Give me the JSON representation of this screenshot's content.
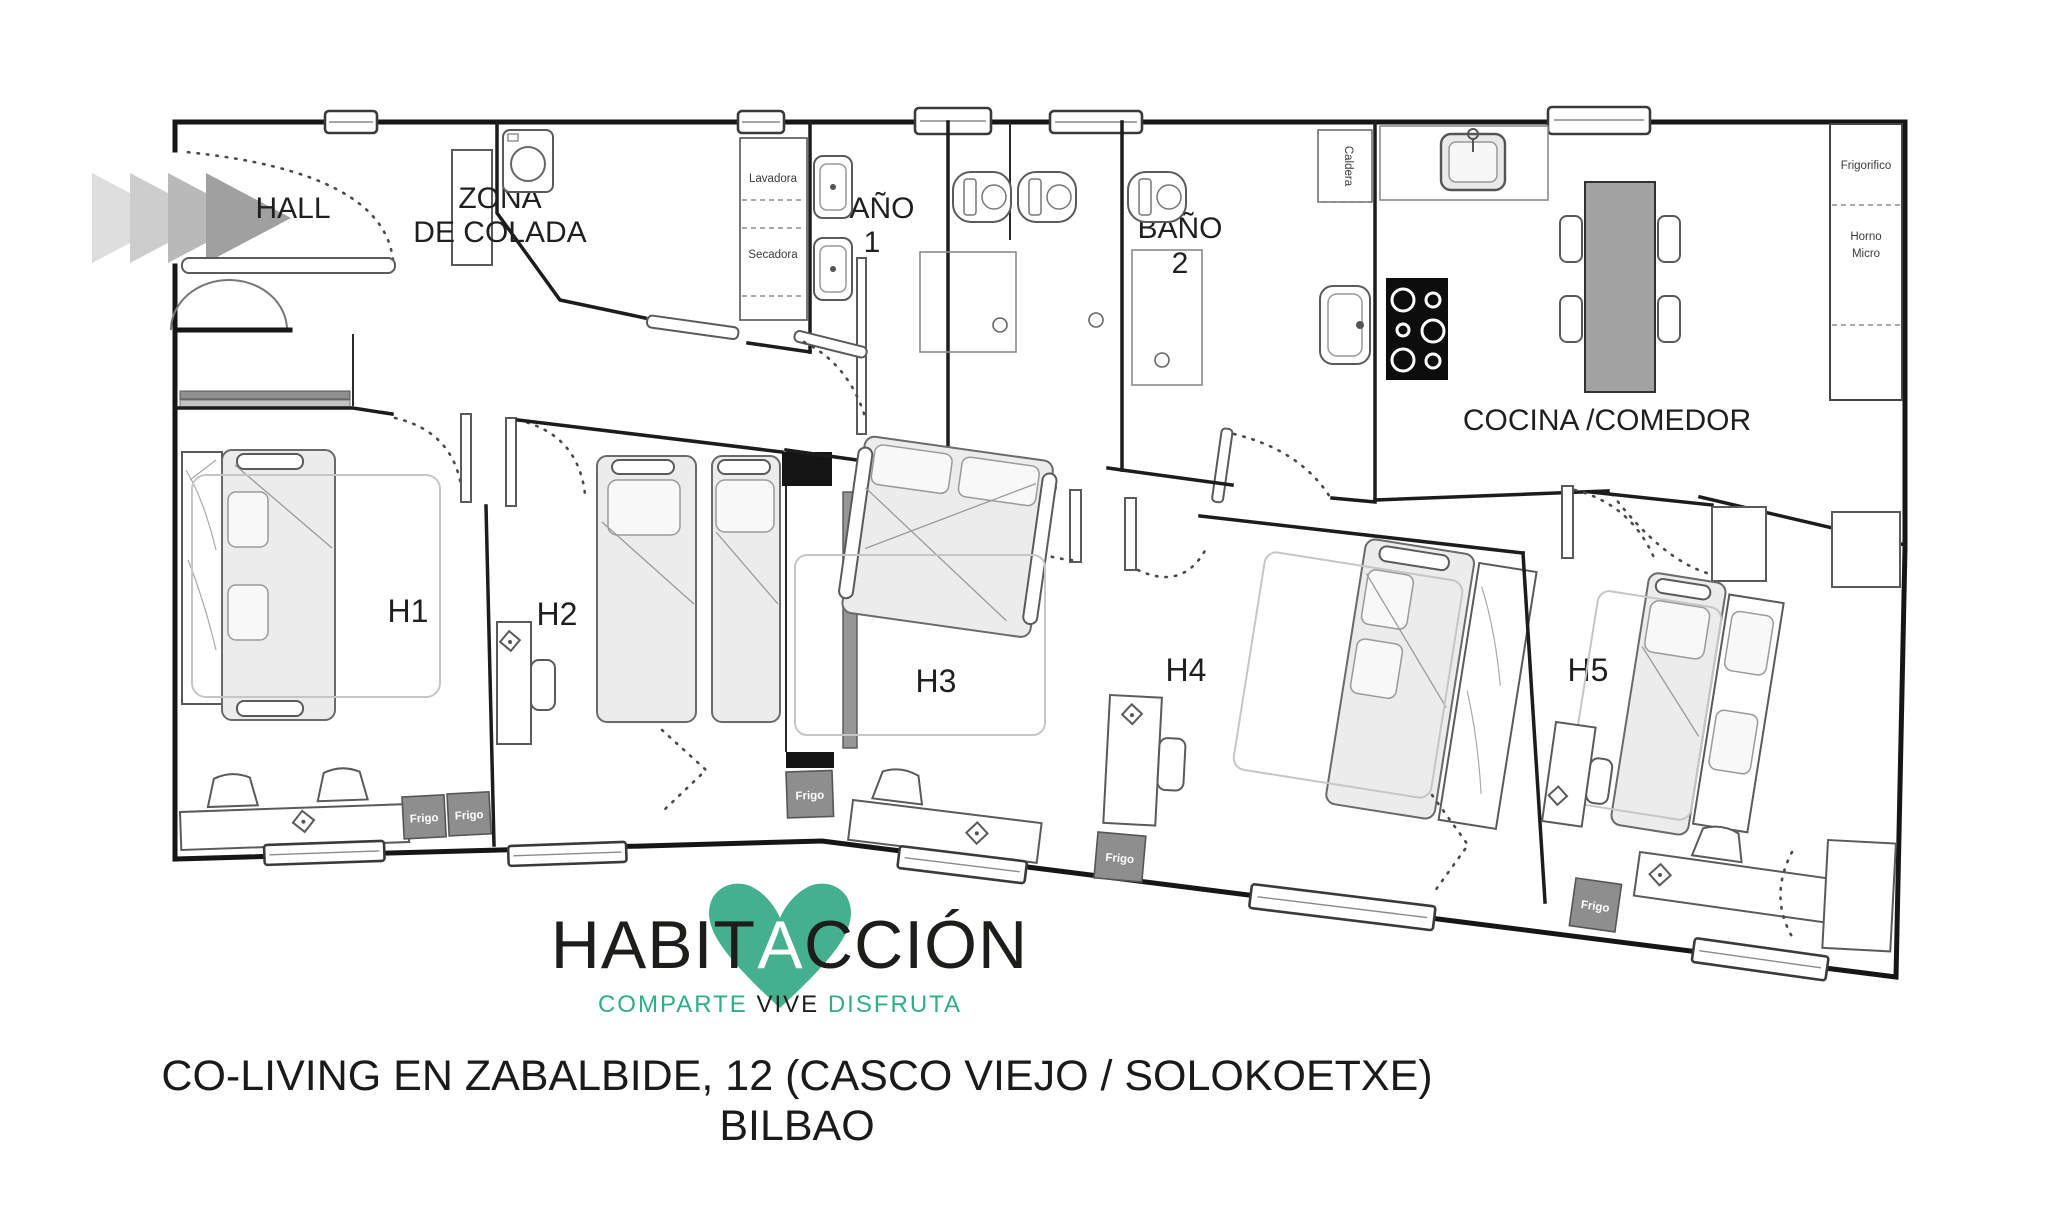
{
  "plan": {
    "rooms": {
      "hall": "HALL",
      "laundry_l1": "ZONA",
      "laundry_l2": "DE COLADA",
      "bath1_l1": "BAÑO",
      "bath1_l2": "1",
      "bath2_l1": "BAÑO",
      "bath2_l2": "2",
      "kitchen": "COCINA /COMEDOR",
      "h1": "H1",
      "h2": "H2",
      "h3": "H3",
      "h4": "H4",
      "h5": "H5"
    },
    "labels": {
      "lavadora": "Lavadora",
      "secadora": "Secadora",
      "caldera": "Caldera",
      "frigorifico": "Frigorifico",
      "horno_l1": "Horno",
      "horno_l2": "Micro",
      "frigo": "Frigo"
    },
    "colors": {
      "wall": "#161616",
      "table_gray": "#a3a3a3",
      "frigo_gray": "#8e8e8e"
    }
  },
  "logo": {
    "word_pre": "HABIT",
    "word_mid": "A",
    "word_post": "CCIÓN",
    "tagline_1": "COMPARTE",
    "tagline_2": "VIVE",
    "tagline_3": "DISFRUTA",
    "heart_color": "#45b08d",
    "teal": "#2ead87",
    "ink": "#1d1d1b"
  },
  "footer": {
    "line1": "CO-LIVING EN ZABALBIDE, 12 (CASCO VIEJO / SOLOKOETXE)",
    "line2": "BILBAO"
  }
}
